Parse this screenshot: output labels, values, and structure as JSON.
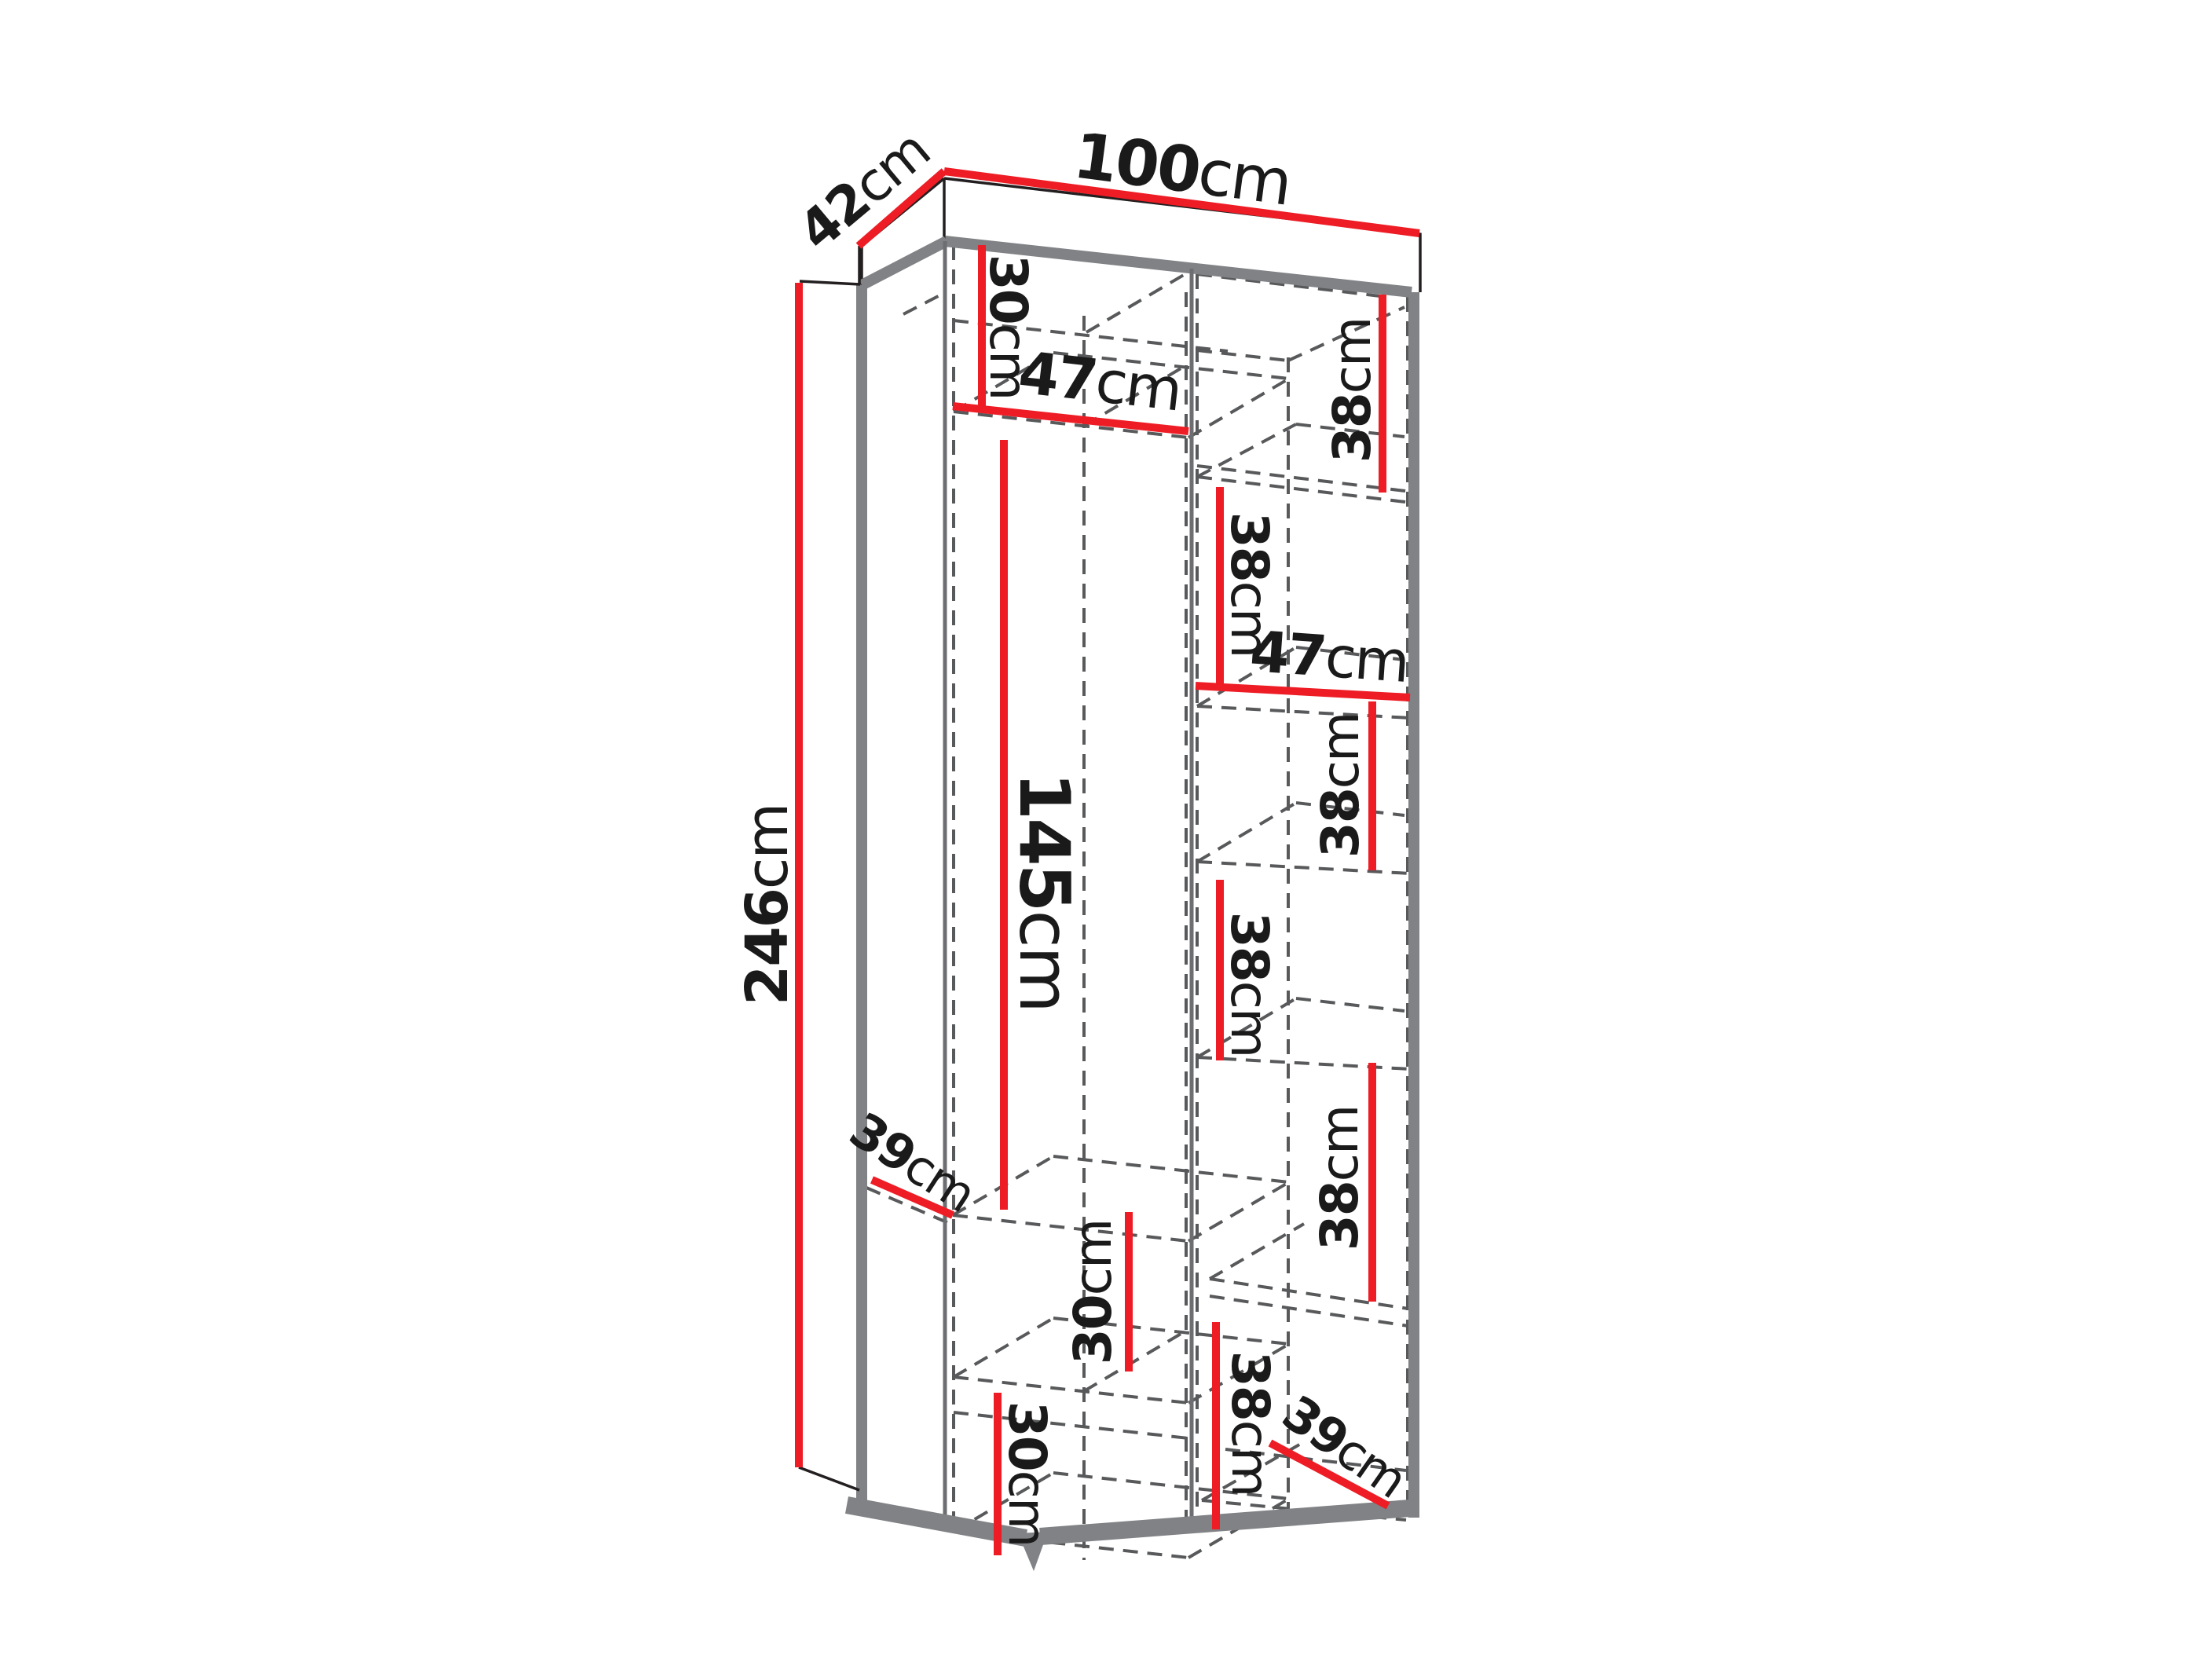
{
  "diagram": {
    "title": "wardrobe-dimension-diagram",
    "unit": "cm",
    "overall_dimensions": {
      "width_cm": 100,
      "depth_cm": 42,
      "height_cm": 246
    },
    "colors": {
      "dimension_line": "#ee1c25",
      "outline_gray": "#808285",
      "hidden_line": "#58595b",
      "label_text": "#1a1a1a",
      "background": "#ffffff"
    },
    "labels": {
      "width": {
        "value": "100",
        "unit": "cm"
      },
      "depth": {
        "value": "42",
        "unit": "cm"
      },
      "height": {
        "value": "246",
        "unit": "cm"
      },
      "top_left_cell_height": {
        "value": "30",
        "unit": "cm"
      },
      "left_section_width": {
        "value": "47",
        "unit": "cm"
      },
      "right_cell_1_height": {
        "value": "38",
        "unit": "cm"
      },
      "right_cell_2_height": {
        "value": "38",
        "unit": "cm"
      },
      "right_section_width": {
        "value": "47",
        "unit": "cm"
      },
      "right_cell_3_height": {
        "value": "38",
        "unit": "cm"
      },
      "right_cell_4_height": {
        "value": "38",
        "unit": "cm"
      },
      "hanging_section_height": {
        "value": "145",
        "unit": "cm"
      },
      "left_shelf_depth": {
        "value": "39",
        "unit": "cm"
      },
      "right_cell_5_height": {
        "value": "38",
        "unit": "cm"
      },
      "middle_cell_height": {
        "value": "30",
        "unit": "cm"
      },
      "bottom_left_cell_height": {
        "value": "30",
        "unit": "cm"
      },
      "bottom_right_cell_height": {
        "value": "38",
        "unit": "cm"
      },
      "right_shelf_depth": {
        "value": "39",
        "unit": "cm"
      }
    }
  }
}
